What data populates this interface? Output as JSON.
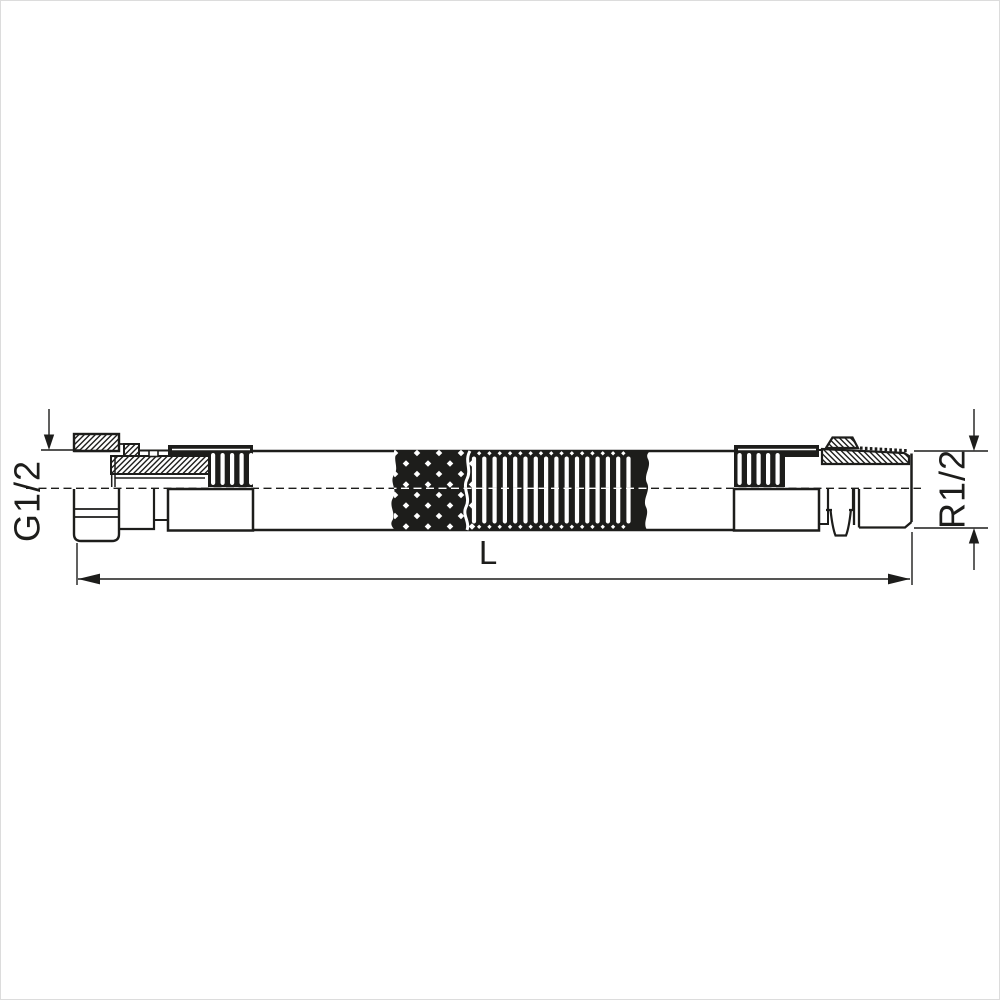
{
  "labels": {
    "left_thread": "G1/2",
    "right_thread": "R1/2",
    "length": "L"
  },
  "colors": {
    "line": "#1d1d1b",
    "background": "#ffffff"
  }
}
